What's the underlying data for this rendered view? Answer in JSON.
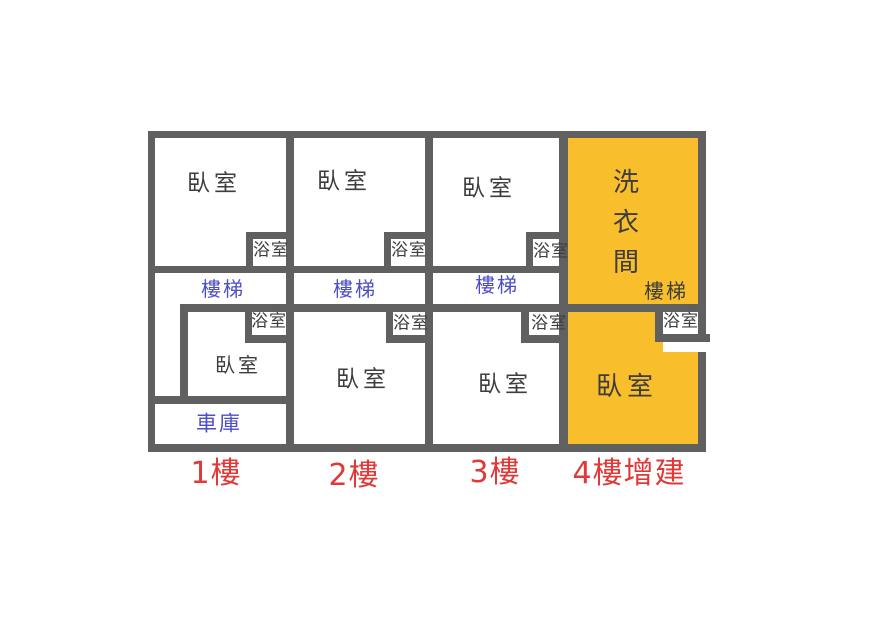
{
  "plan_title": "multi-floor house floor plan",
  "labels": {
    "bedroom": "臥室",
    "bathroom": "浴室",
    "stairs": "樓梯",
    "garage": "車庫",
    "laundry_room": "洗衣間"
  },
  "floors": [
    {
      "label": "1樓",
      "highlighted": false,
      "rooms": [
        "臥室",
        "浴室",
        "樓梯",
        "浴室",
        "臥室",
        "車庫"
      ]
    },
    {
      "label": "2樓",
      "highlighted": false,
      "rooms": [
        "臥室",
        "浴室",
        "樓梯",
        "浴室",
        "臥室"
      ]
    },
    {
      "label": "3樓",
      "highlighted": false,
      "rooms": [
        "臥室",
        "浴室",
        "樓梯",
        "浴室",
        "臥室"
      ]
    },
    {
      "label": "4樓增建",
      "highlighted": true,
      "rooms": [
        "洗衣間",
        "樓梯",
        "浴室",
        "臥室"
      ]
    }
  ],
  "colors": {
    "wall": "#606060",
    "room_text": "#3d3d3d",
    "feature_text": "#4d4dc7",
    "floor_caption_text": "#e13838",
    "addition_highlight_fill": "#f8be2c"
  }
}
